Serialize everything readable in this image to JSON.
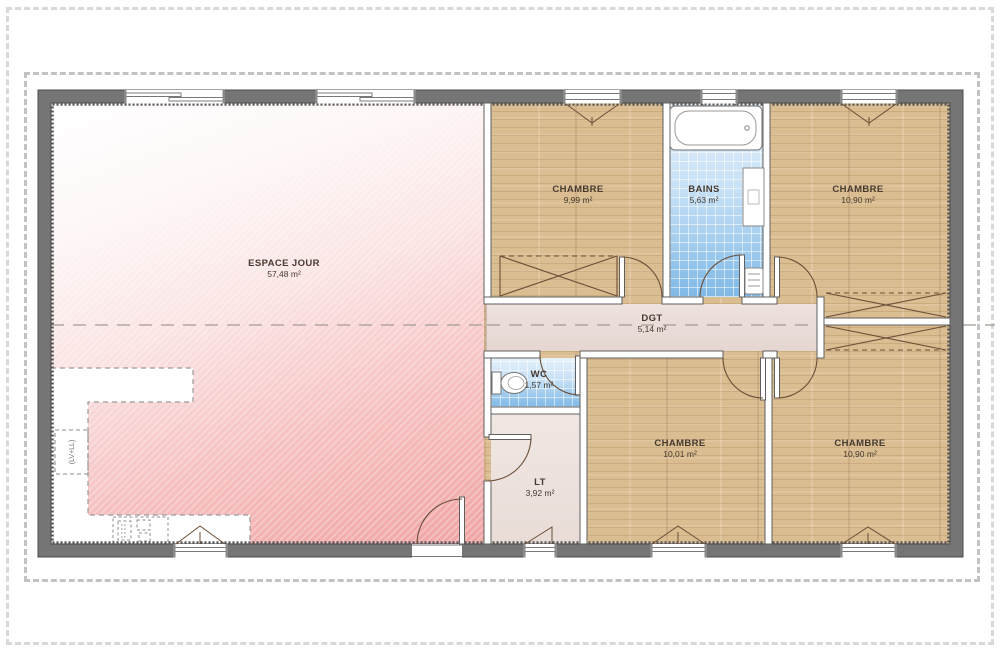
{
  "plan_title": "floor-plan",
  "rooms": [
    {
      "id": "espace-jour",
      "name": "ESPACE JOUR",
      "area": "57,48 m²"
    },
    {
      "id": "chambre-1",
      "name": "CHAMBRE",
      "area": "9,99 m²"
    },
    {
      "id": "bains",
      "name": "BAINS",
      "area": "5,63 m²"
    },
    {
      "id": "chambre-2",
      "name": "CHAMBRE",
      "area": "10,90 m²"
    },
    {
      "id": "dgt",
      "name": "DGT",
      "area": "5,14 m²"
    },
    {
      "id": "wc",
      "name": "WC",
      "area": "1,57 m²"
    },
    {
      "id": "lt",
      "name": "LT",
      "area": "3,92 m²"
    },
    {
      "id": "chambre-3",
      "name": "CHAMBRE",
      "area": "10,01 m²"
    },
    {
      "id": "chambre-4",
      "name": "CHAMBRE",
      "area": "10,90 m²"
    }
  ],
  "annotations": {
    "kitchen_note": "(LV+LL)"
  },
  "colors": {
    "wall": "#757575",
    "living_pink": "#f0a4a4",
    "wood": "#dbbd92",
    "tile_blue": "#98c7ec",
    "hall_floor": "#e9dbd6",
    "boundary_dash": "#c2c2c2"
  }
}
